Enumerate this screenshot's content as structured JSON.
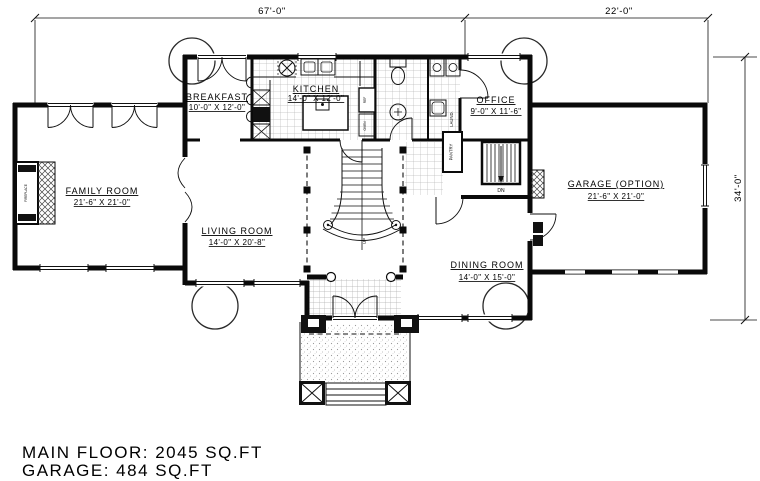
{
  "plan": {
    "dimensions": {
      "top_main": "67'-0\"",
      "top_garage": "22'-0\"",
      "right_side": "34'-0\""
    },
    "rooms": {
      "breakfast": {
        "name": "BREAKFAST",
        "size": "10'-0\" X 12'-0\""
      },
      "kitchen": {
        "name": "KITCHEN",
        "size": "14'-0\" X 12'-0\""
      },
      "office": {
        "name": "OFFICE",
        "size": "9'-0\" X 11'-6\""
      },
      "family_room": {
        "name": "FAMILY ROOM",
        "size": "21'-6\" X 21'-0\""
      },
      "living_room": {
        "name": "LIVING ROOM",
        "size": "14'-0\" X 20'-8\""
      },
      "dining_room": {
        "name": "DINING ROOM",
        "size": "14'-0\" X 15'-0\""
      },
      "garage": {
        "name": "GARAGE (OPTION)",
        "size": "21'-6\" X 21'-0\""
      }
    },
    "small_labels": {
      "pantry": "PANTRY",
      "laundry": "LAUND.",
      "down": "DN",
      "up": "UP",
      "fireplace": "FIREPLACE",
      "ref": "REF",
      "oven": "OVEN"
    },
    "summary": {
      "main_floor": "MAIN FLOOR: 2045 SQ.FT",
      "garage": "GARAGE: 484 SQ.FT"
    },
    "colors": {
      "line": "#000000",
      "tile": "#bbbbbb",
      "background": "#ffffff"
    }
  }
}
